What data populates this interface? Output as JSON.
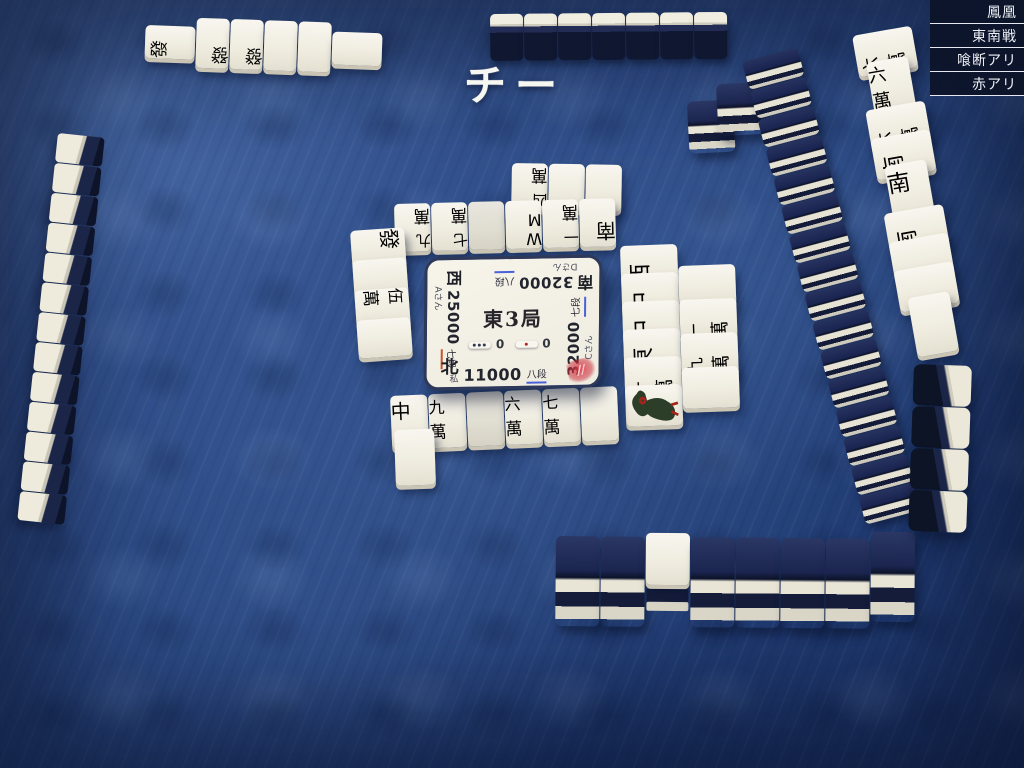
{
  "rules_panel": {
    "items": [
      {
        "label": "鳳凰"
      },
      {
        "label": "東南戦"
      },
      {
        "label": "喰断アリ"
      },
      {
        "label": "赤アリ"
      }
    ]
  },
  "call_banner": {
    "text": "チー"
  },
  "center_panel": {
    "round": "東3局",
    "honba_count": "0",
    "riichi_count": "0",
    "players": {
      "top": {
        "wind": "南",
        "score": "32000",
        "rank": "八段",
        "name": "Dさん",
        "rank_underline": "blue"
      },
      "left": {
        "wind": "西",
        "score": "25000",
        "rank": "七段",
        "name": "Aさん",
        "rank_underline": "red"
      },
      "right": {
        "score": "32000",
        "rank": "七段",
        "name": "Cさん",
        "rank_underline": "blue"
      },
      "bottom": {
        "wind": "北",
        "score": "11000",
        "rank": "八段",
        "name": "私",
        "rank_underline": "blue"
      }
    },
    "stamp": true
  },
  "colors": {
    "accent_red": "#a3251c",
    "tile_back_navy": "#141d3b",
    "tile_face_ivory": "#f2efe5",
    "table_blue": "#2c4a88",
    "rank_underline_blue": "#4a62d8",
    "rank_underline_red": "#c8542a"
  },
  "tile_glyphs": {
    "m1": {
      "n": "一",
      "s": "萬"
    },
    "m4": {
      "n": "四",
      "s": "萬"
    },
    "m5": {
      "n": "伍",
      "s": "萬"
    },
    "m6": {
      "n": "六",
      "s": "萬"
    },
    "m7": {
      "n": "七",
      "s": "萬"
    },
    "m9": {
      "n": "九",
      "s": "萬"
    },
    "ton": {
      "c": "東"
    },
    "nan": {
      "c": "南"
    },
    "sha": {
      "c": "西"
    },
    "pei": {
      "c": "北"
    },
    "chun": {
      "c": "中"
    },
    "hatsu": {
      "c": "發"
    },
    "haku": {
      "c": ""
    },
    "s8": {
      "w": "W",
      "m": "M"
    }
  },
  "groups": [
    {
      "name": "top-player-meld-row",
      "kind": "flat",
      "dir": "row",
      "x": 146,
      "y": 16,
      "tw": 33,
      "th": 50,
      "face": 180,
      "gap": 1,
      "rot": 2,
      "align": "center",
      "z": 3,
      "tiles": [
        "hatsu|s",
        "hatsu",
        "hatsu",
        "p3",
        "p1",
        "p2|s"
      ]
    },
    {
      "name": "top-player-hand",
      "kind": "standback",
      "x": 490,
      "y": 14,
      "uw": 33,
      "uh": 47,
      "count": 7,
      "rot": -0.5,
      "z": 3
    },
    {
      "name": "top-wall-remnant",
      "kind": "wallbits",
      "x": 684,
      "y": 86,
      "uw": 46,
      "uh": 52,
      "rot": -3,
      "z": 2,
      "units": [
        {
          "dx": 2,
          "dy": 16
        },
        {
          "dx": 32,
          "dy": 0
        }
      ]
    },
    {
      "name": "right-wall",
      "kind": "wallcol",
      "x": 742,
      "y": 62,
      "uw": 57,
      "uh": 29,
      "count": 16,
      "rot": -15,
      "z": 2
    },
    {
      "name": "left-player-hand",
      "kind": "sidewall",
      "x": 58,
      "y": 133,
      "uw": 47,
      "uh": 29,
      "count": 13,
      "rot": 6,
      "z": 3
    },
    {
      "name": "right-player-hand",
      "kind": "sidewall2",
      "x": 914,
      "y": 364,
      "uw": 58,
      "uh": 41,
      "count": 4,
      "rot": 2,
      "z": 4
    },
    {
      "name": "bottom-wall",
      "kind": "wallrow",
      "x": 556,
      "y": 536,
      "uw": 44,
      "uh": 90,
      "count": 8,
      "dora_index": 2,
      "dora": "s4",
      "rot": 0.5,
      "z": 2
    },
    {
      "name": "top-player-discards-row2",
      "kind": "flat",
      "dir": "row",
      "x": 512,
      "y": 163,
      "tw": 36,
      "th": 47,
      "face": 180,
      "gap": 1,
      "rot": 1,
      "z": 3,
      "tiles": [
        "m4",
        "p8",
        "p1"
      ]
    },
    {
      "name": "top-player-discards-row1",
      "kind": "flat",
      "dir": "row",
      "x": 394,
      "y": 204,
      "tw": 36,
      "th": 48,
      "face": 180,
      "gap": 1,
      "rot": -1.5,
      "z": 3,
      "tiles": [
        "m9",
        "m7",
        "haku",
        "s8",
        "m1",
        "nan"
      ]
    },
    {
      "name": "left-player-discards",
      "kind": "flat",
      "dir": "col",
      "x": 350,
      "y": 231,
      "tw": 54,
      "th": 38,
      "face": 90,
      "step": -8,
      "rot": -4,
      "z": 3,
      "tiles": [
        "hatsu",
        "p9",
        "m5",
        "p9"
      ]
    },
    {
      "name": "right-player-discards-col1",
      "kind": "flat",
      "dir": "col",
      "x": 620,
      "y": 246,
      "tw": 57,
      "th": 41,
      "face": 270,
      "step": -13,
      "rot": -2,
      "z": 3,
      "tiles": [
        "sha",
        "chun",
        "chun",
        "ton",
        "m1",
        "s1"
      ]
    },
    {
      "name": "right-player-discards-col2",
      "kind": "flat",
      "dir": "col",
      "x": 678,
      "y": 266,
      "tw": 57,
      "th": 41,
      "face": 270,
      "step": -7,
      "rot": -2,
      "z": 3,
      "tiles": [
        "p6",
        "m1",
        "m9",
        "p9"
      ]
    },
    {
      "name": "right-player-melds",
      "kind": "flat",
      "dir": "col",
      "x": 852,
      "y": 36,
      "tw": 60,
      "th": 42,
      "face": 270,
      "step": -13,
      "rot": -10,
      "z": 3,
      "tiles": [
        "m6",
        "m6|s",
        "m6",
        "nan",
        "nan|s",
        "nan",
        "p7",
        "p8",
        "p9|s"
      ]
    },
    {
      "name": "bottom-player-discards-row1",
      "kind": "flat",
      "dir": "row",
      "x": 390,
      "y": 396,
      "tw": 37,
      "th": 54,
      "face": 0,
      "gap": 1,
      "rot": -2.5,
      "z": 3,
      "tiles": [
        "chun",
        "m9",
        "haku",
        "m6",
        "m7",
        "s9"
      ]
    },
    {
      "name": "bottom-player-discards-row2",
      "kind": "flat",
      "dir": "row",
      "x": 394,
      "y": 430,
      "tw": 40,
      "th": 56,
      "face": 0,
      "gap": 0,
      "rot": -2,
      "z": 4,
      "tiles": [
        "p8"
      ]
    },
    {
      "name": "bottom-player-melds",
      "kind": "flat",
      "dir": "row",
      "x": 706,
      "y": 640,
      "tw": 41,
      "th": 58,
      "face": 0,
      "gap": 0,
      "rot": -2,
      "align": "end",
      "z": 5,
      "tiles": [
        "m5r",
        "m5|s",
        "m5",
        "pei|s",
        "pei",
        "pei"
      ]
    },
    {
      "name": "bottom-player-hand",
      "kind": "standfront",
      "x": 206,
      "y": 636,
      "tw": 45,
      "th": 72,
      "gap": 1,
      "rot": 0,
      "z": 5,
      "interact": true,
      "tiles": [
        "p1",
        "p1",
        "p2",
        "p3",
        "s5r",
        "s6",
        "s8"
      ]
    }
  ]
}
